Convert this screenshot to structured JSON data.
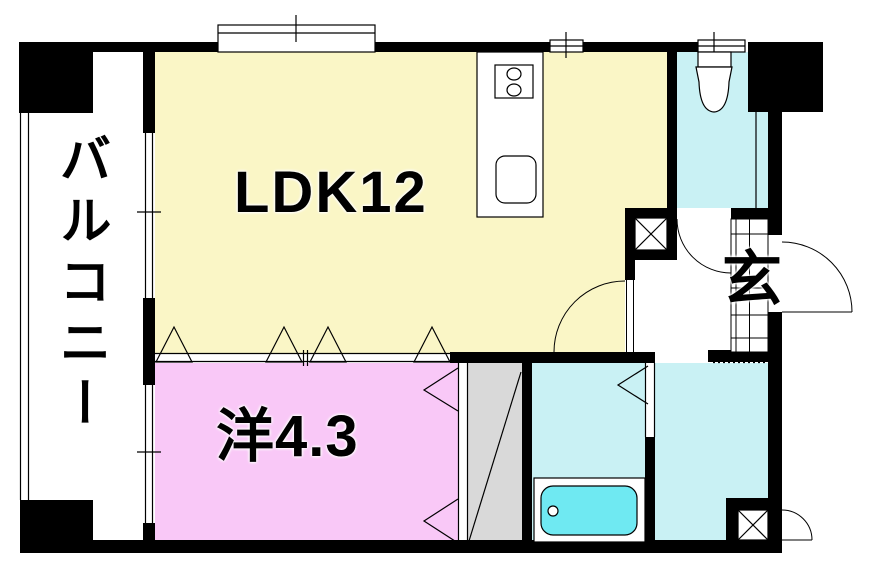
{
  "labels": {
    "balcony": "バルコニー",
    "ldk": "LDK12",
    "western_room": "洋4.3",
    "entrance": "玄"
  },
  "colors": {
    "background": "#FFFFFF",
    "wall": "#000000",
    "line": "#000000",
    "ldk_floor": "#FAF6C6",
    "western_floor": "#F9C8F7",
    "wet_floor": "#C9F1F4",
    "bathtub": "#6FE9F2",
    "closet_floor": "#D9D9D9",
    "hall_floor": "#FFFFFF",
    "fixture_fill": "#FFFFFF"
  }
}
